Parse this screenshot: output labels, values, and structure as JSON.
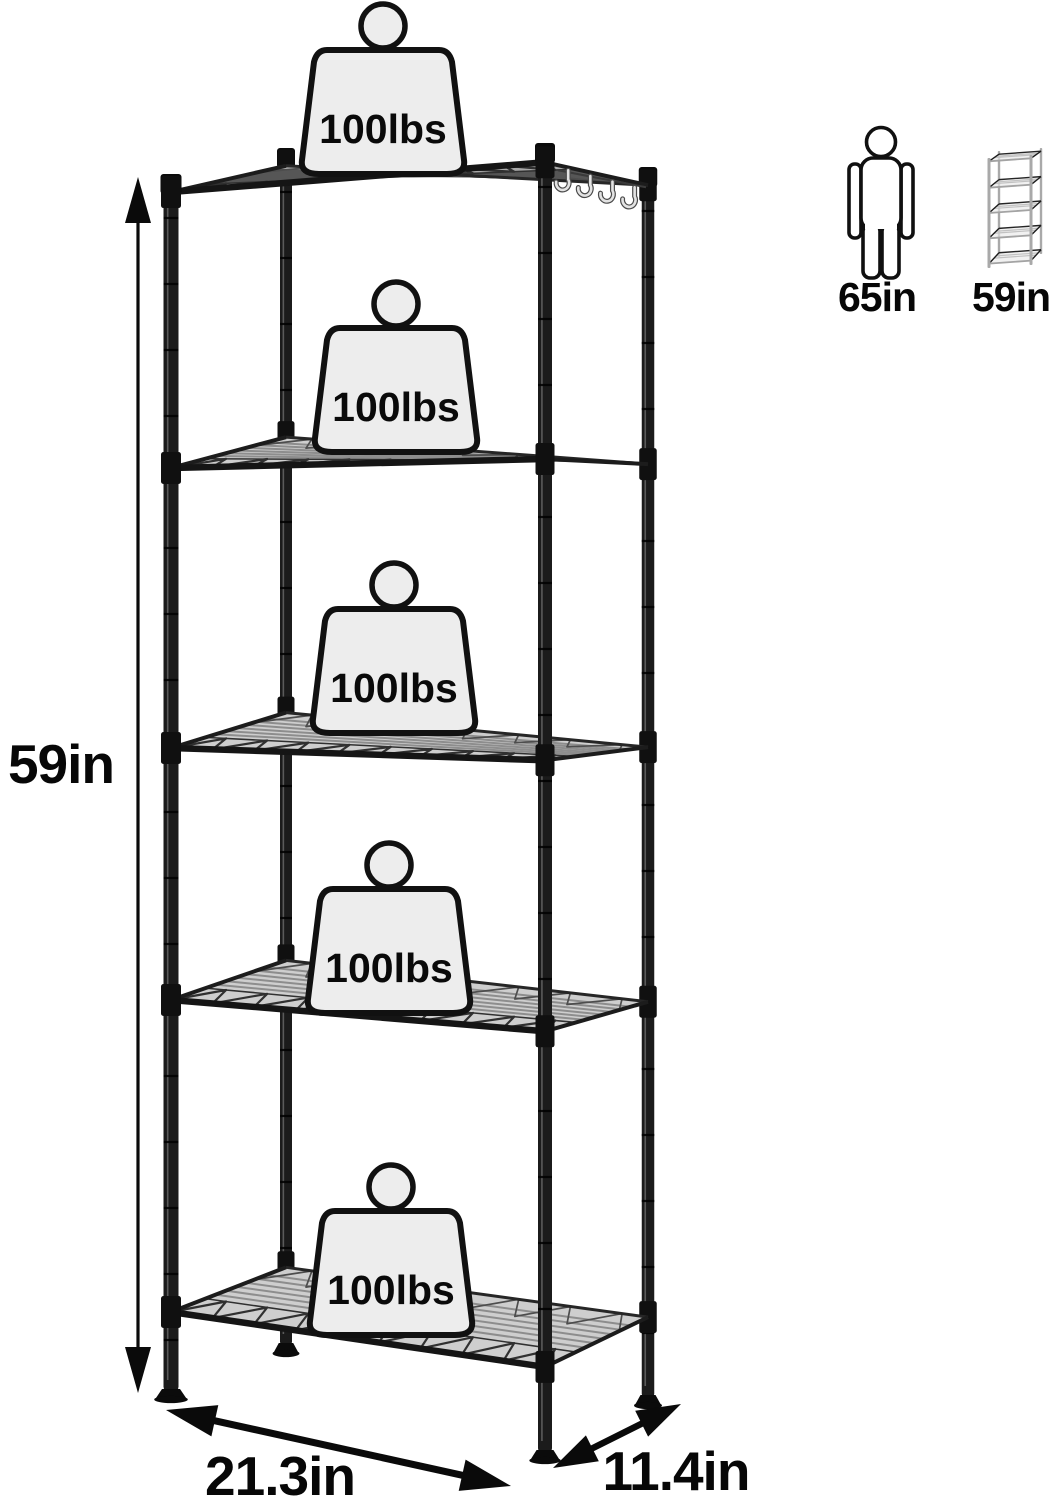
{
  "shelves": [
    {
      "capacity": "100lbs"
    },
    {
      "capacity": "100lbs"
    },
    {
      "capacity": "100lbs"
    },
    {
      "capacity": "100lbs"
    },
    {
      "capacity": "100lbs"
    }
  ],
  "dimensions": {
    "height": "59in",
    "width": "21.3in",
    "depth": "11.4in"
  },
  "comparison": {
    "person_height": "65in",
    "unit_height": "59in"
  },
  "colors": {
    "frame": "#1b1b1b",
    "text": "#0a0a0a",
    "weight_fill": "#ededed"
  }
}
